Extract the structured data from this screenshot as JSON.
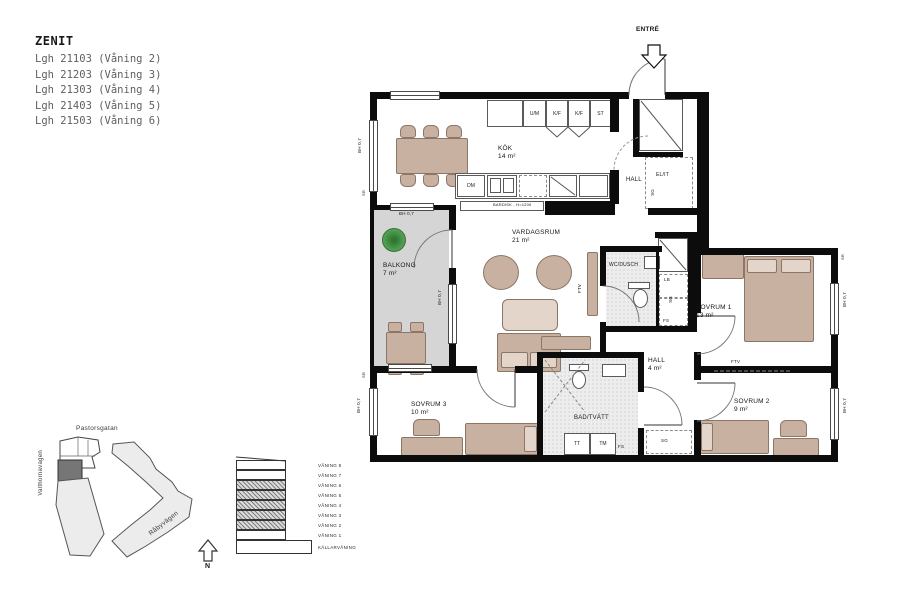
{
  "header": {
    "project": "ZENIT",
    "units": [
      "Lgh 21103 (Våning 2)",
      "Lgh 21203 (Våning 3)",
      "Lgh 21303 (Våning 4)",
      "Lgh 21403 (Våning 5)",
      "Lgh 21503 (Våning 6)"
    ]
  },
  "plan": {
    "entre": "ENTRÉ",
    "rooms": {
      "kok": {
        "name": "KÖK",
        "area": "14 m²"
      },
      "vardagsrum": {
        "name": "VARDAGSRUM",
        "area": "21 m²"
      },
      "balkong": {
        "name": "BALKONG",
        "area": "7 m²"
      },
      "sovrum1": {
        "name": "SOVRUM 1",
        "area": "13 m²"
      },
      "sovrum2": {
        "name": "SOVRUM 2",
        "area": "9 m²"
      },
      "sovrum3": {
        "name": "SOVRUM 3",
        "area": "10 m²"
      },
      "wc_dusch": {
        "name": "WC/DUSCH"
      },
      "bad_tvatt": {
        "name": "BAD/TVÄTT"
      },
      "hall_entre": {
        "name": "HALL"
      },
      "hall2": {
        "name": "HALL",
        "area": "4 m²"
      },
      "el_it": {
        "name": "EL/IT"
      }
    },
    "fixtures": {
      "cabinets": [
        "U/M",
        "K/F",
        "K/F",
        "ST"
      ],
      "dm": "DM",
      "bardisk": "BARDISK - H=1200",
      "tt": "TT",
      "tm": "TM",
      "fs": "FS",
      "lb": "LB",
      "sg": "SG",
      "ftv": "FTV",
      "bh": "BH 0,7",
      "sr": "SR"
    }
  },
  "site": {
    "streets": {
      "top": "Pastorsgatan",
      "left": "Valthornavägen",
      "bottom": "Råbyvägen"
    }
  },
  "section": {
    "floors": [
      "VÅNING 8",
      "VÅNING 7",
      "VÅNING 6",
      "VÅNING 5",
      "VÅNING 4",
      "VÅNING 3",
      "VÅNING 2",
      "VÅNING 1",
      "KÄLLARVÅNING"
    ]
  },
  "compass": {
    "north": "N"
  },
  "colors": {
    "wall": "#0c0c0c",
    "furniture": "#c8b1a1",
    "balcony": "#d5d5d5",
    "plant": "#4f9c50",
    "site_highlight": "#767676"
  }
}
